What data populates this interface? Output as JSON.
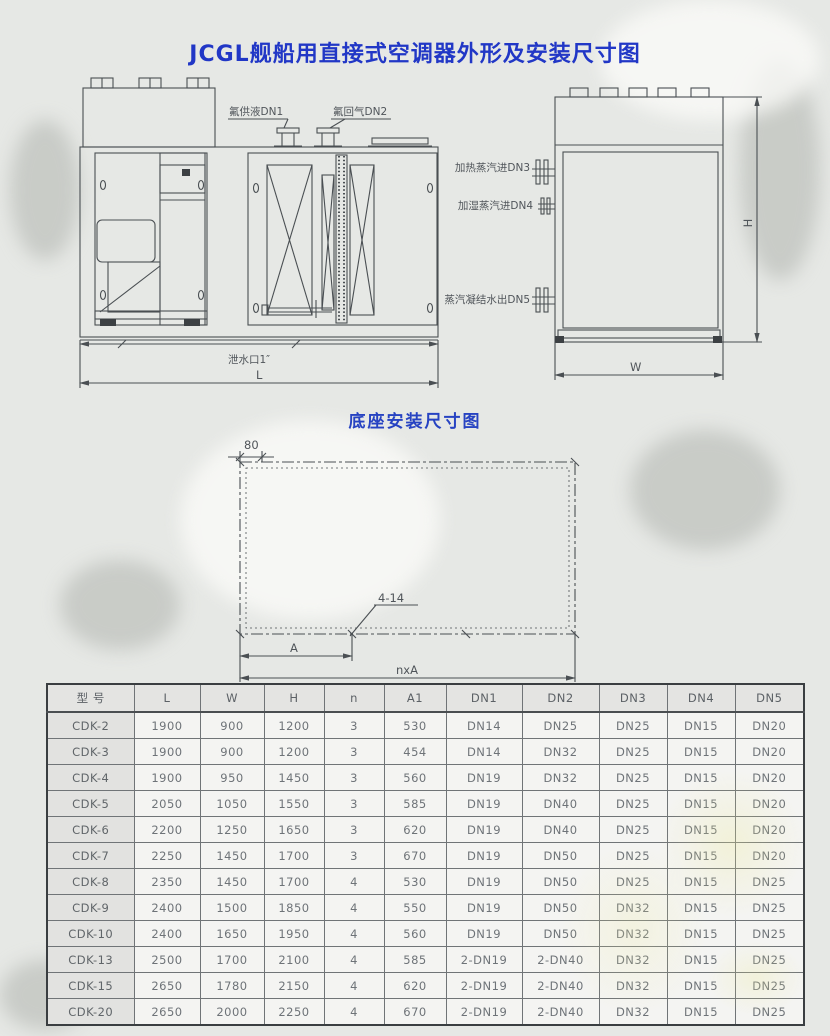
{
  "page": {
    "title": "JCGL舰船用直接式空调器外形及安装尺寸图",
    "base_diagram_title": "底座安装尺寸图"
  },
  "front_view": {
    "label_dn1": "氟供液DN1",
    "label_dn2": "氟回气DN2",
    "label_drain": "泄水口1″",
    "dim_length": "L"
  },
  "side_view": {
    "label_dn3": "加热蒸汽进DN3",
    "label_dn4": "加湿蒸汽进DN4",
    "label_dn5": "蒸汽凝结水出DN5",
    "dim_width": "W",
    "dim_height": "H"
  },
  "base_diagram": {
    "dim_offset": "80",
    "hole_callout": "4-14",
    "dim_pitch": "A",
    "dim_total": "nxA"
  },
  "table": {
    "columns": [
      "型 号",
      "L",
      "W",
      "H",
      "n",
      "A1",
      "DN1",
      "DN2",
      "DN3",
      "DN4",
      "DN5"
    ],
    "rows": [
      [
        "CDK-2",
        "1900",
        "900",
        "1200",
        "3",
        "530",
        "DN14",
        "DN25",
        "DN25",
        "DN15",
        "DN20"
      ],
      [
        "CDK-3",
        "1900",
        "900",
        "1200",
        "3",
        "454",
        "DN14",
        "DN32",
        "DN25",
        "DN15",
        "DN20"
      ],
      [
        "CDK-4",
        "1900",
        "950",
        "1450",
        "3",
        "560",
        "DN19",
        "DN32",
        "DN25",
        "DN15",
        "DN20"
      ],
      [
        "CDK-5",
        "2050",
        "1050",
        "1550",
        "3",
        "585",
        "DN19",
        "DN40",
        "DN25",
        "DN15",
        "DN20"
      ],
      [
        "CDK-6",
        "2200",
        "1250",
        "1650",
        "3",
        "620",
        "DN19",
        "DN40",
        "DN25",
        "DN15",
        "DN20"
      ],
      [
        "CDK-7",
        "2250",
        "1450",
        "1700",
        "3",
        "670",
        "DN19",
        "DN50",
        "DN25",
        "DN15",
        "DN20"
      ],
      [
        "CDK-8",
        "2350",
        "1450",
        "1700",
        "4",
        "530",
        "DN19",
        "DN50",
        "DN25",
        "DN15",
        "DN25"
      ],
      [
        "CDK-9",
        "2400",
        "1500",
        "1850",
        "4",
        "550",
        "DN19",
        "DN50",
        "DN32",
        "DN15",
        "DN25"
      ],
      [
        "CDK-10",
        "2400",
        "1650",
        "1950",
        "4",
        "560",
        "DN19",
        "DN50",
        "DN32",
        "DN15",
        "DN25"
      ],
      [
        "CDK-13",
        "2500",
        "1700",
        "2100",
        "4",
        "585",
        "2-DN19",
        "2-DN40",
        "DN32",
        "DN15",
        "DN25"
      ],
      [
        "CDK-15",
        "2650",
        "1780",
        "2150",
        "4",
        "620",
        "2-DN19",
        "2-DN40",
        "DN32",
        "DN15",
        "DN25"
      ],
      [
        "CDK-20",
        "2650",
        "2000",
        "2250",
        "4",
        "670",
        "2-DN19",
        "2-DN40",
        "DN32",
        "DN15",
        "DN25"
      ]
    ]
  },
  "colors": {
    "title_blue": "#2137c6",
    "drawing_line": "#4a4f53",
    "table_text": "#6e7378",
    "page_background": "#e6e8e5"
  }
}
